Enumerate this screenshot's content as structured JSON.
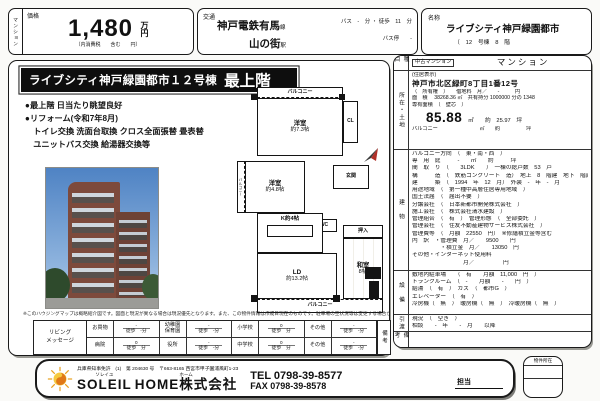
{
  "colors": {
    "accent_red": "#b03028",
    "title_bg": "#0e0e0e"
  },
  "header": {
    "category_tab": "マンション",
    "price": {
      "label": "価格",
      "value": "1,480",
      "unit": "万円",
      "tax_note": "（内消費税　　含む　　円）"
    },
    "transport": {
      "label": "交通",
      "line": "神戸電鉄有馬",
      "line_suffix": "線",
      "bus_info": "バス　-　分 ・ 徒歩　11　分",
      "station": "山の街",
      "station_suffix": "駅",
      "bus_stop": "バス停　　-"
    },
    "name": {
      "label": "名称",
      "value": "ライブシティ神戸緑園都市",
      "sub": "（　12　号棟　8　階"
    }
  },
  "left": {
    "title_main": "ライブシティ神戸緑園都市１２号棟",
    "title_em": "最上階",
    "bullets": [
      "●最上階 日当たり眺望良好",
      "●リフォーム(令和7年8月)",
      "　トイレ交換 洗面台取換 クロス全面張替 畳表替",
      "　ユニットバス交換 給湯器交換等"
    ],
    "floorplan": {
      "balcony_top": "バルコニー",
      "room1_l1": "洋室",
      "room1_l2": "約7.3帖",
      "closet": "CL",
      "entrance": "玄関",
      "room2_l1": "洋室",
      "room2_l2": "約4.8帖",
      "balcony_side": "バルコニー",
      "wc": "WC",
      "kitchen": "K約4帖",
      "ld_l1": "LD",
      "ld_l2": "約13.2帖",
      "oshiire": "押入",
      "washitsu_l1": "和室",
      "washitsu_l2": "8帖",
      "balcony_bottom": "バルコニー"
    },
    "disclaimer": "※このハウジングマップは概略紹介図です。図面と現況が異なる場合は現況優先となります。また、この物件情報は作成日現在のものです。駐車場の空状況等は変更する場合があります。",
    "access": {
      "left_label_l1": "リビング",
      "left_label_l2": "メッセージ",
      "rows": [
        [
          {
            "label": "お買物",
            "v": "-",
            "walk": "徒歩　-分"
          },
          {
            "label": "幼稚園\n保育園",
            "v": "-",
            "walk": "徒歩　-分"
          },
          {
            "label": "小学校",
            "v": "0",
            "walk": "徒歩　分"
          },
          {
            "label": "その他",
            "v": "-",
            "walk": "徒歩　-分"
          }
        ],
        [
          {
            "label": "病院",
            "v": "0",
            "walk": "徒歩　分"
          },
          {
            "label": "役所",
            "v": "-",
            "walk": "徒歩　-分"
          },
          {
            "label": "中学校",
            "v": "0",
            "walk": "徒歩　分"
          },
          {
            "label": "その他",
            "v": "-",
            "walk": "徒歩　-分"
          }
        ]
      ],
      "biko": "備考"
    }
  },
  "right": {
    "sections": [
      {
        "key": "shumoku",
        "label": "種目",
        "rows": [
          {
            "cls": "flexrow",
            "cells": [
              {
                "t": "中古マンション",
                "cls": "box-sm",
                "name": "property-category"
              },
              {
                "t": "マンション",
                "cls": "md-center",
                "name": "property-type"
              }
            ]
          }
        ]
      },
      {
        "key": "shozai",
        "label": "所在・土地",
        "rows": [
          {
            "cls": "tiny",
            "cells": [
              {
                "t": "(住居表示)",
                "name": "address-note"
              }
            ]
          },
          {
            "cls": "addr",
            "cells": [
              {
                "t": "神戸市北区緑町8丁目1番12号",
                "name": "address"
              }
            ]
          },
          {
            "cls": "tiny",
            "cells": [
              {
                "t": "（　所有権　）　　借地料　月／　　-　　　円",
                "name": "land-right"
              }
            ]
          },
          {
            "cls": "tiny",
            "cells": [
              {
                "t": "面　積　 38268.36 ㎡　共有持分 1000000 分の 1348",
                "name": "land-area"
              }
            ]
          },
          {
            "cls": "tiny",
            "cells": [
              {
                "t": "専有面積　（　壁芯　）",
                "name": "exclusive-area-label"
              }
            ]
          },
          {
            "cells": [
              {
                "t": "85.88",
                "cls": "big",
                "name": "exclusive-area-value"
              },
              {
                "t": "　㎡　　約　25.97　坪",
                "cls": "after-big",
                "name": "exclusive-area-tsubo"
              }
            ]
          },
          {
            "cls": "tiny",
            "cells": [
              {
                "t": "バルコニー　　　　　　　　㎡　　約　　　　　坪",
                "name": "balcony-area"
              }
            ]
          }
        ]
      },
      {
        "key": "tatemono",
        "label": "建　物",
        "rows": [
          {
            "cells": [
              {
                "t": "バルコニー方向　（　東・南・西　）",
                "name": "balcony-direction"
              }
            ]
          },
          {
            "cells": [
              {
                "t": "専　用　庭　　　-　　㎡　　約　　　坪",
                "name": "private-garden"
              }
            ]
          },
          {
            "cells": [
              {
                "t": "間　取　り　（　　3LDK　　）　一棟の総戸数　53　戸",
                "name": "layout"
              }
            ]
          },
          {
            "cells": [
              {
                "t": "構　　　造　（　鉄筋コンクリート　造）　地上　8　階建　地下　階建",
                "name": "structure"
              }
            ]
          },
          {
            "cells": [
              {
                "t": "建　　　築　（　1994　年　12　月）　外装　-　年　-　月",
                "name": "built-date"
              }
            ]
          },
          {
            "cells": [
              {
                "t": "用途地域　（　第一種中高層住居専用地域　）",
                "name": "zoning"
              }
            ]
          },
          {
            "cells": [
              {
                "t": "国土法届　（　届出不要　）",
                "name": "land-act"
              }
            ]
          },
          {
            "cells": [
              {
                "t": "分譲会社　（　日本新都市開発株式会社　）",
                "name": "developer"
              }
            ]
          },
          {
            "cells": [
              {
                "t": "施工会社　（　株式会社清水建設　）",
                "name": "builder"
              }
            ]
          },
          {
            "cells": [
              {
                "t": "管理組合　（　有　）　管理形態　（　全部委託　）",
                "name": "management-association"
              }
            ]
          },
          {
            "cells": [
              {
                "t": "管理会社　（　住友不動産建物サービス株式会社　）",
                "name": "management-company"
              }
            ]
          },
          {
            "cells": [
              {
                "t": "管理費等　（　月額　22550　円）　※修繕積立金等含む",
                "name": "management-fee"
              }
            ]
          },
          {
            "cells": [
              {
                "t": "内　訳　・管理費　月／　　9500　　円",
                "name": "fee-breakdown-kanri"
              }
            ]
          },
          {
            "cells": [
              {
                "t": "　　　　　・積立金　月／　　13050　円",
                "name": "fee-breakdown-tsumitate"
              }
            ]
          },
          {
            "cells": [
              {
                "t": "その他・インターネット使用料",
                "name": "fee-other-label"
              }
            ]
          },
          {
            "cells": [
              {
                "t": "　　　　　　　　　月／　　　　　円",
                "name": "fee-other-value"
              }
            ]
          }
        ]
      },
      {
        "key": "setsubi",
        "label": "設　備",
        "rows": [
          {
            "cells": [
              {
                "t": "敷地内駐車場　　（　有　　月額　11,000　円　）",
                "name": "parking"
              }
            ]
          },
          {
            "cells": [
              {
                "t": "トランクルーム　（　-　　月額　　-　　円　）",
                "name": "trunk-room"
              }
            ]
          },
          {
            "cells": [
              {
                "t": "給湯　（　有　）　ガス　（　都市G　）",
                "name": "hot-water-gas"
              }
            ]
          },
          {
            "cells": [
              {
                "t": "エレベーター　（　有　）",
                "name": "elevator"
              }
            ]
          },
          {
            "cells": [
              {
                "t": "冷房機（　無　）　暖房機（　無　）　冷暖房機（　無　）",
                "name": "aircon"
              }
            ]
          }
        ]
      },
      {
        "key": "hikiwatashi",
        "label": "引渡",
        "rows": [
          {
            "cells": [
              {
                "t": "現況　（　空き　）",
                "name": "current-status"
              }
            ]
          },
          {
            "cells": [
              {
                "t": "相談　　-　年　　-　月　　以降",
                "name": "handover-timing"
              }
            ]
          }
        ]
      },
      {
        "key": "biko",
        "label": "備　考",
        "rows": []
      }
    ]
  },
  "footer": {
    "license": "兵庫県知事免許　(1)　第 204630 号　〒663-8165 西宮市甲子園浦風町1-23",
    "ruby1": "ソレイユ",
    "name1": "SOLEIL",
    "ruby2": "ホーム",
    "name2": "HOME株式会社",
    "tel": "TEL 0798-39-8577",
    "fax": "FAX 0798-39-8578",
    "tantou": "担当",
    "bukken_label": "物件所在"
  }
}
